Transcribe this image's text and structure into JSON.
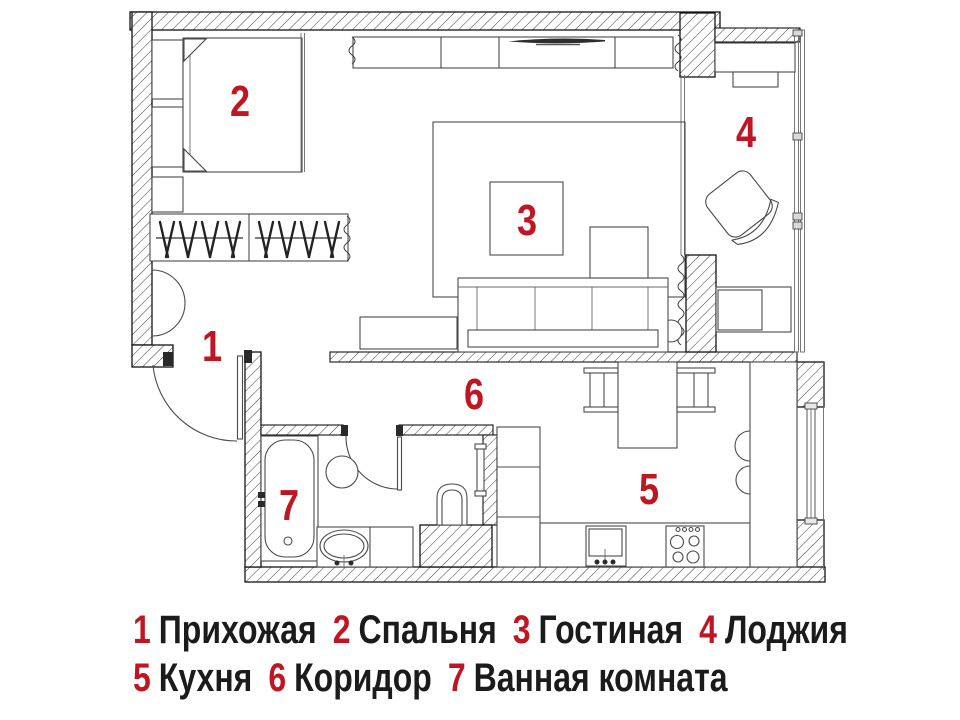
{
  "palette": {
    "accent": "#be1622",
    "wall": "#141414",
    "line": "#4a4a4a"
  },
  "rooms": [
    {
      "number": "1",
      "name": "Прихожая"
    },
    {
      "number": "2",
      "name": "Спальня"
    },
    {
      "number": "3",
      "name": "Гостиная"
    },
    {
      "number": "4",
      "name": "Лоджия"
    },
    {
      "number": "5",
      "name": "Кухня"
    },
    {
      "number": "6",
      "name": "Коридор"
    },
    {
      "number": "7",
      "name": "Ванная комната"
    }
  ]
}
